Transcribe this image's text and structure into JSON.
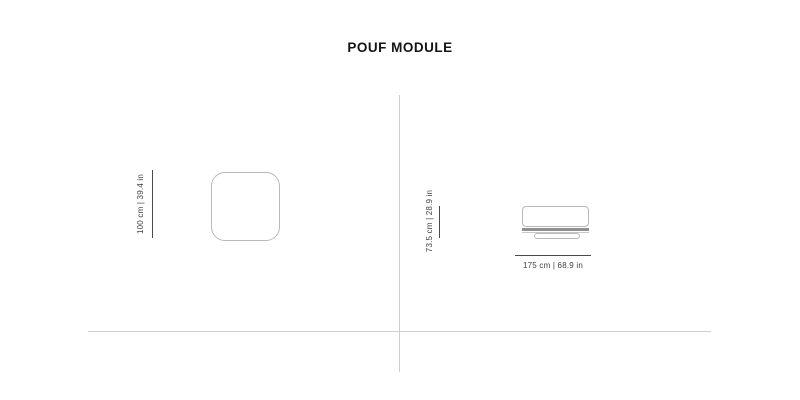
{
  "title": "POUF MODULE",
  "views": {
    "top_view": {
      "height_label": "100 cm | 39.4 in"
    },
    "side_view": {
      "height_label": "73.5 cm | 28.9 in",
      "width_label": "175 cm | 68.9 in"
    }
  },
  "colors": {
    "background": "#ffffff",
    "title_text": "#141414",
    "dimension_text": "#3f3f3f",
    "dimension_line": "#4a4a4a",
    "shape_outline": "#b9b9b9",
    "seat_band": "#8f8f8f",
    "divider_line": "#cfcfcf"
  }
}
